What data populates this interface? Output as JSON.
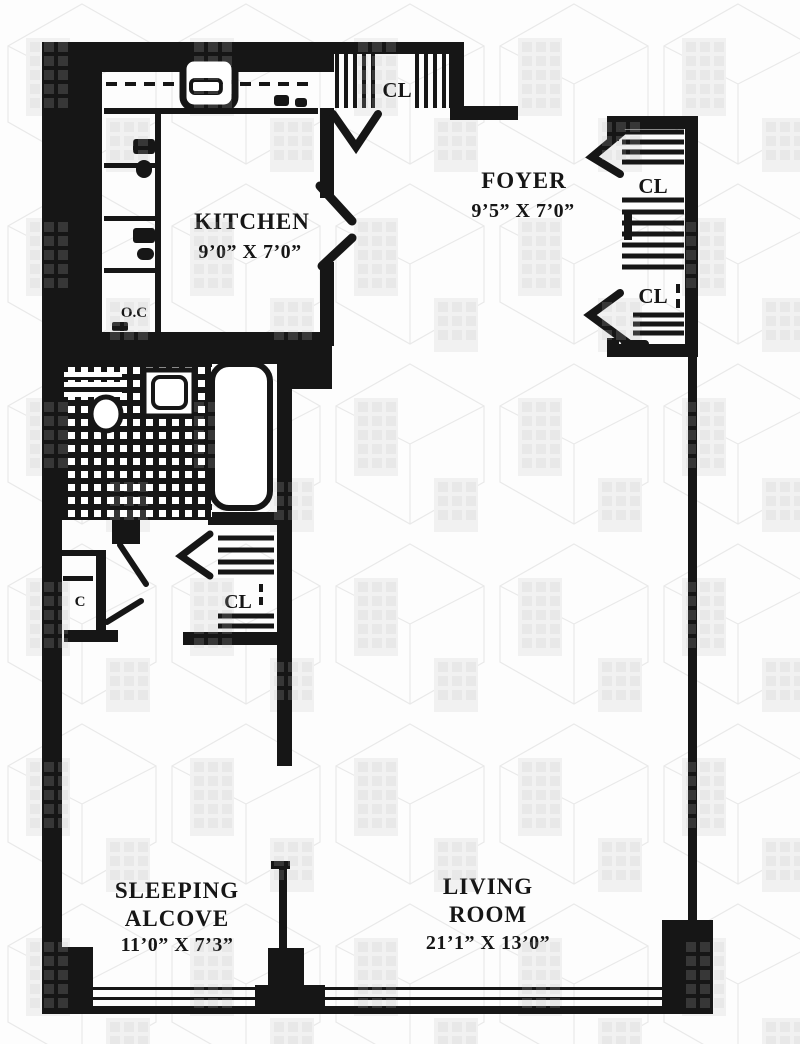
{
  "colors": {
    "ink": "#161616",
    "paper": "#fdfdfd",
    "watermark_gray": "#ececec"
  },
  "rooms": {
    "kitchen": {
      "name": "KITCHEN",
      "dims": "9’0” X 7’0”"
    },
    "foyer": {
      "name": "FOYER",
      "dims": "9’5” X 7’0”"
    },
    "sleeping_alcove": {
      "name_line1": "SLEEPING",
      "name_line2": "ALCOVE",
      "dims": "11’0” X 7’3”"
    },
    "living_room": {
      "name_line1": "LIVING",
      "name_line2": "ROOM",
      "dims": "21’1” X 13’0”"
    }
  },
  "closets": {
    "entry_closet": "CL",
    "foyer_closet_upper": "CL",
    "foyer_closet_lower": "CL",
    "hall_closet": "CL",
    "linen_closet": "C"
  },
  "kitchen_appliances": {
    "counter_label": "O.C"
  }
}
